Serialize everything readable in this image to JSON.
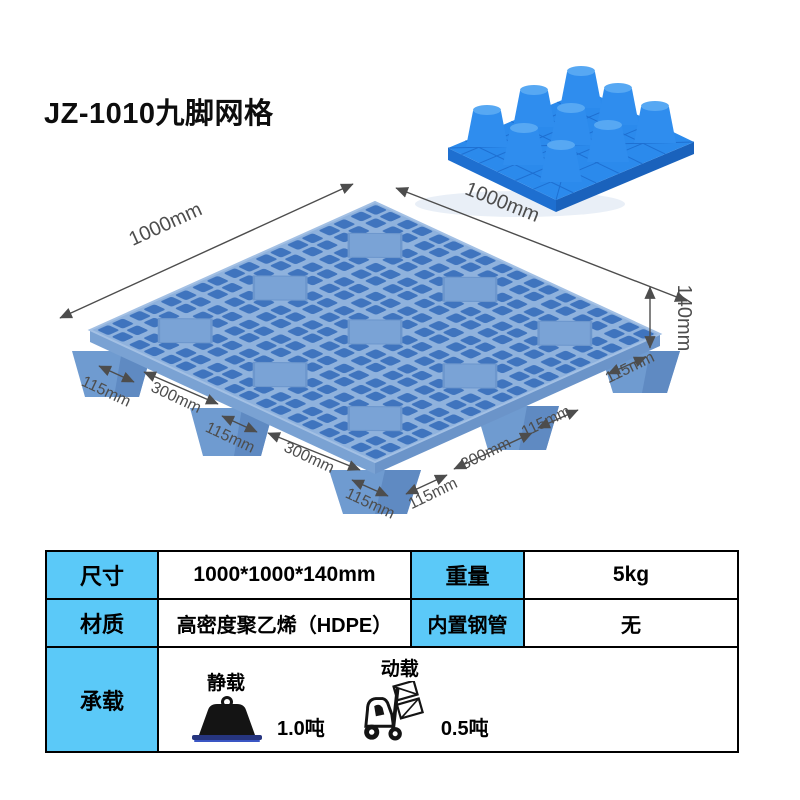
{
  "title": "JZ-1010九脚网格",
  "colors": {
    "table_header_bg": "#5bc9f8",
    "pallet_deck_light": "#8fb2dd",
    "pallet_hole_blue": "#3f74be",
    "small_pallet_bright_blue": "#2384ea",
    "dimension_text": "#4d4d4d"
  },
  "annotations": {
    "top_left_len": "1000mm",
    "top_right_len": "1000mm",
    "height_len": "140mm",
    "left_edge": [
      "115mm",
      "300mm",
      "115mm",
      "300mm",
      "115mm"
    ],
    "right_edge": [
      "115mm",
      "300mm",
      "115mm",
      "115mm"
    ]
  },
  "table": {
    "row1": {
      "c1": "尺寸",
      "c2": "1000*1000*140mm",
      "c3": "重量",
      "c4": "5kg"
    },
    "row2": {
      "c1": "材质",
      "c2": "高密度聚乙烯（HDPE）",
      "c3": "内置钢管",
      "c4": "无"
    },
    "row3": {
      "c1": "承载",
      "static_label": "静载",
      "static_value": "1.0吨",
      "dynamic_label": "动载",
      "dynamic_value": "0.5吨"
    }
  }
}
